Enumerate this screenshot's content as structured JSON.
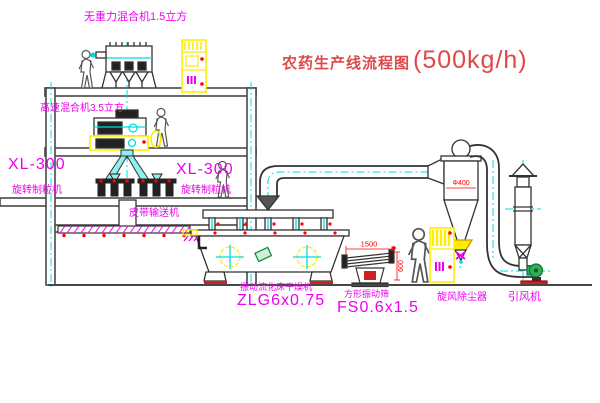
{
  "title": {
    "main": "农药生产线流程图",
    "capacity": "(500kg/h)"
  },
  "labels": {
    "mixer_top": "无重力混合机1.5立方",
    "mixer_high_speed": "高速混合机3.5立方",
    "granulator_left_model": "XL-300",
    "granulator_left_name": "旋转制粒机",
    "granulator_right_model": "XL-300",
    "granulator_right_name": "旋转制粒机",
    "belt_conveyor": "皮带输送机",
    "dryer_name": "振动流化床干燥机",
    "dryer_model": "ZLG6x0.75",
    "sieve_name": "方形振动筛",
    "sieve_model": "FS0.6x1.5",
    "cyclone_name": "旋风除尘器",
    "fan_name": "引风机"
  },
  "dimensions": {
    "sieve_length": "1500",
    "sieve_width": "600",
    "cyclone_diameter": "Φ400"
  },
  "colors": {
    "label_magenta": "#ee00ee",
    "title_red": "#e04848",
    "dimension_red": "#ff0000",
    "centerline_cyan": "#00dddd",
    "cabinet_yellow": "#ffee00",
    "fan_green": "#2fae57",
    "line_dark": "#444444"
  }
}
